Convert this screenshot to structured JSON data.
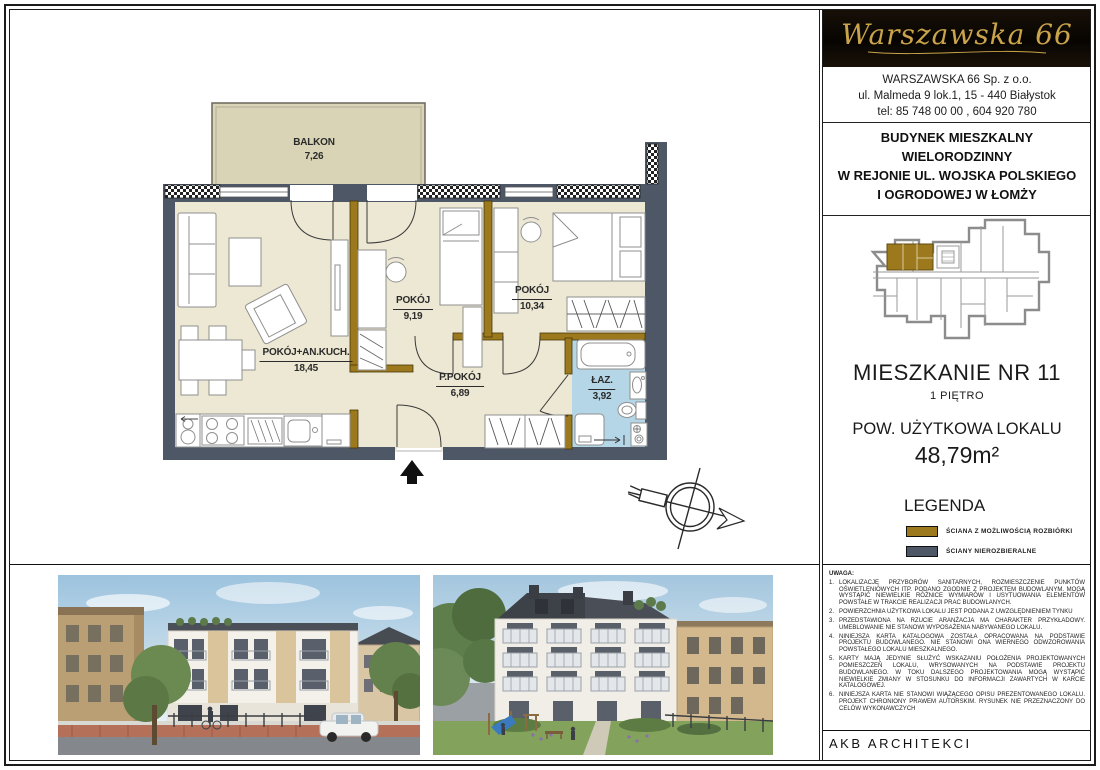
{
  "header": {
    "logo_script": "Warszawska 66",
    "company_line1": "WARSZAWSKA  66   Sp.  z o.o.",
    "company_line2": "ul. Malmeda 9  lok.1,   15 - 440 Białystok",
    "company_line3": "tel: 85 748 00 00 ,  604 920 780"
  },
  "project": {
    "title_line1": "BUDYNEK  MIESZKALNY",
    "title_line2": "WIELORODZINNY",
    "title_line3": "W  REJONIE  UL. WOJSKA  POLSKIEGO",
    "title_line4": "I  OGRODOWEJ   W  ŁOMŻY"
  },
  "apartment": {
    "name": "MIESZKANIE NR 11",
    "floor": "1 PIĘTRO",
    "area_label": "POW. UŻYTKOWA LOKALU",
    "area_value": "48,79m²"
  },
  "plan": {
    "rooms": [
      {
        "name": "BALKON",
        "area": "7,26"
      },
      {
        "name": "POKÓJ+AN.KUCH.",
        "area": "18,45"
      },
      {
        "name": "POKÓJ",
        "area": "9,19"
      },
      {
        "name": "POKÓJ",
        "area": "10,34"
      },
      {
        "name": "P.POKÓJ",
        "area": "6,89"
      },
      {
        "name": "ŁAZ.",
        "area": "3,92"
      }
    ]
  },
  "legend": {
    "title": "LEGENDA",
    "items": [
      {
        "label": "ŚCIANA  Z  MOŻLIWOŚCIĄ  ROZBIÓRKI",
        "color": "#9c791c"
      },
      {
        "label": "ŚCIANY  NIEROZBIERALNE",
        "color": "#4d5766"
      }
    ]
  },
  "notes": {
    "title": "UWAGA:",
    "items": [
      "LOKALIZACJĘ PRZYBORÓW SANITARNYCH,  ROZMIESZCZENIE PUNKTÓW OŚWIETLENIOWYCH ITP.  PODANO ZGODNIE Z PROJEKTEM  BUDOWLANYM. MOGĄ  WYSTĄPIĆ NIEWIELKIE RÓŻNICE WYMIARÓW I USYTUOWANIA ELEMENTÓW POWSTAŁE W TRAKCIE REALIZACJI PRAC BUDOWLANYCH.",
      "POWIERZCHNIA UŻYTKOWA LOKALU JEST PODANA Z UWZGLĘDNIENIEM TYNKU",
      "PRZEDSTAWIONA NA RZUCIE ARANŻACJA MA CHARAKTER PRZYKŁADOWY. UMEBLOWANIE NIE STANOWI WYPOSAŻENIA NABYWANEGO LOKALU.",
      "NINIEJSZA KARTA KATALOGOWA ZOSTAŁA OPRACOWANA NA PODSTAWIE PROJEKTU BUDOWLANEGO. NIE STANOWI ONA WIERNEGO ODWZOROWANIA POWSTAŁEGO LOKALU MIESZKALNEGO.",
      "KARTY MAJĄ JEDYNIE SŁUŻYĆ WSKAZANIU POŁOŻENIA PROJEKTOWANYCH POMIESZCZEŃ LOKALU, WRYSOWANYCH NA PODSTAWIE PROJEKTU BUDOWLANEGO. W TOKU DALSZEGO PROJEKTOWANIA MOGĄ WYSTĄPIĆ NIEWIELKIE ZMIANY W STOSUNKU DO INFORMACJI ZAWARTYCH W KARCIE KATALOGOWEJ.",
      "NINIEJSZA KARTA NIE STANOWI WIĄŻĄCEGO OPISU PREZENTOWANEGO LOKALU. PROJEKT CHRONIONY PRAWEM AUTORSKIM.  RYSUNEK NIE PRZEZNACZONY DO CELÓW WYKONAWCZYCH"
    ]
  },
  "footer": {
    "studio": "AKB  ARCHITEKCI"
  },
  "colors": {
    "wall_fixed": "#4d5766",
    "wall_removable": "#9c791c",
    "floor": "#ede8d3",
    "bath_floor": "#b5d6e6",
    "balcony_floor": "#d9d4b6",
    "logo_bg": "#0a0703",
    "logo_gold": "#c9a44a"
  }
}
